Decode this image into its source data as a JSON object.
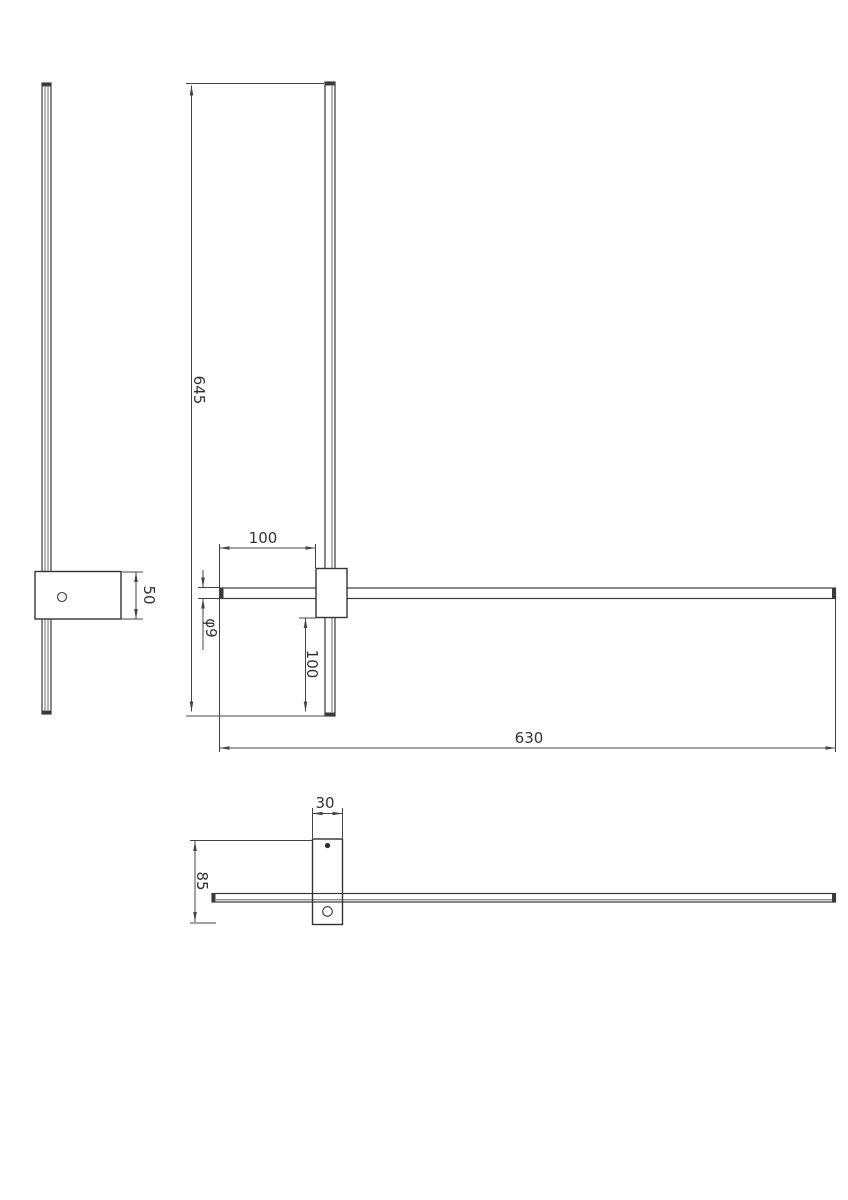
{
  "page": {
    "background": "#ffffff",
    "line_color": "#3a3a3a",
    "text_color": "#333333",
    "drawing_type": "wall-lamp-technical-drawing"
  },
  "views": {
    "side": {
      "bracket_height": "50"
    },
    "front": {
      "bar_length": "645",
      "top_offset": "100",
      "tube_diameter": "φ9",
      "bottom_offset": "100",
      "horizontal_length": "630"
    },
    "top": {
      "bracket_width": "30",
      "bracket_depth": "85"
    }
  }
}
